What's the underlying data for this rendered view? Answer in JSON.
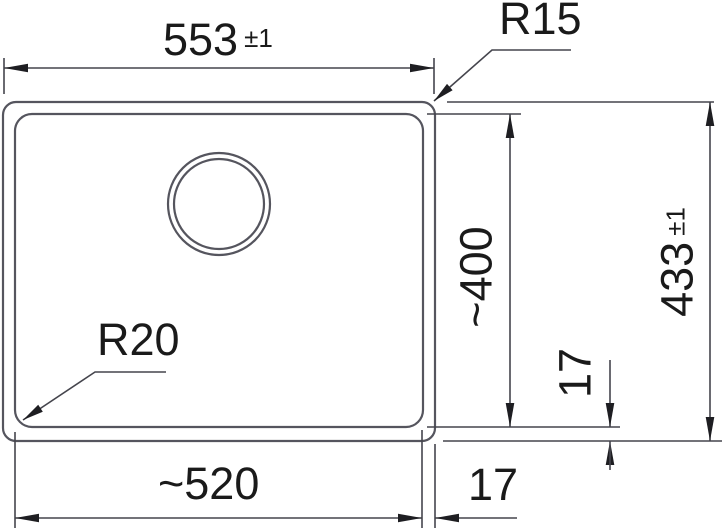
{
  "style": {
    "background": "#ffffff",
    "outline_color": "#55555e",
    "dimension_line_color": "#45454d",
    "text_color": "#1a1a1a"
  },
  "labels": {
    "outer_width": {
      "value": "553",
      "tolerance": "±1"
    },
    "outer_corner_radius": "R15",
    "inner_depth": "~400",
    "outer_depth": {
      "value": "433",
      "tolerance": "±1"
    },
    "rim_offset_vertical": "17",
    "inner_corner_radius": "R20",
    "inner_width": "~520",
    "rim_offset_horizontal": "17"
  }
}
